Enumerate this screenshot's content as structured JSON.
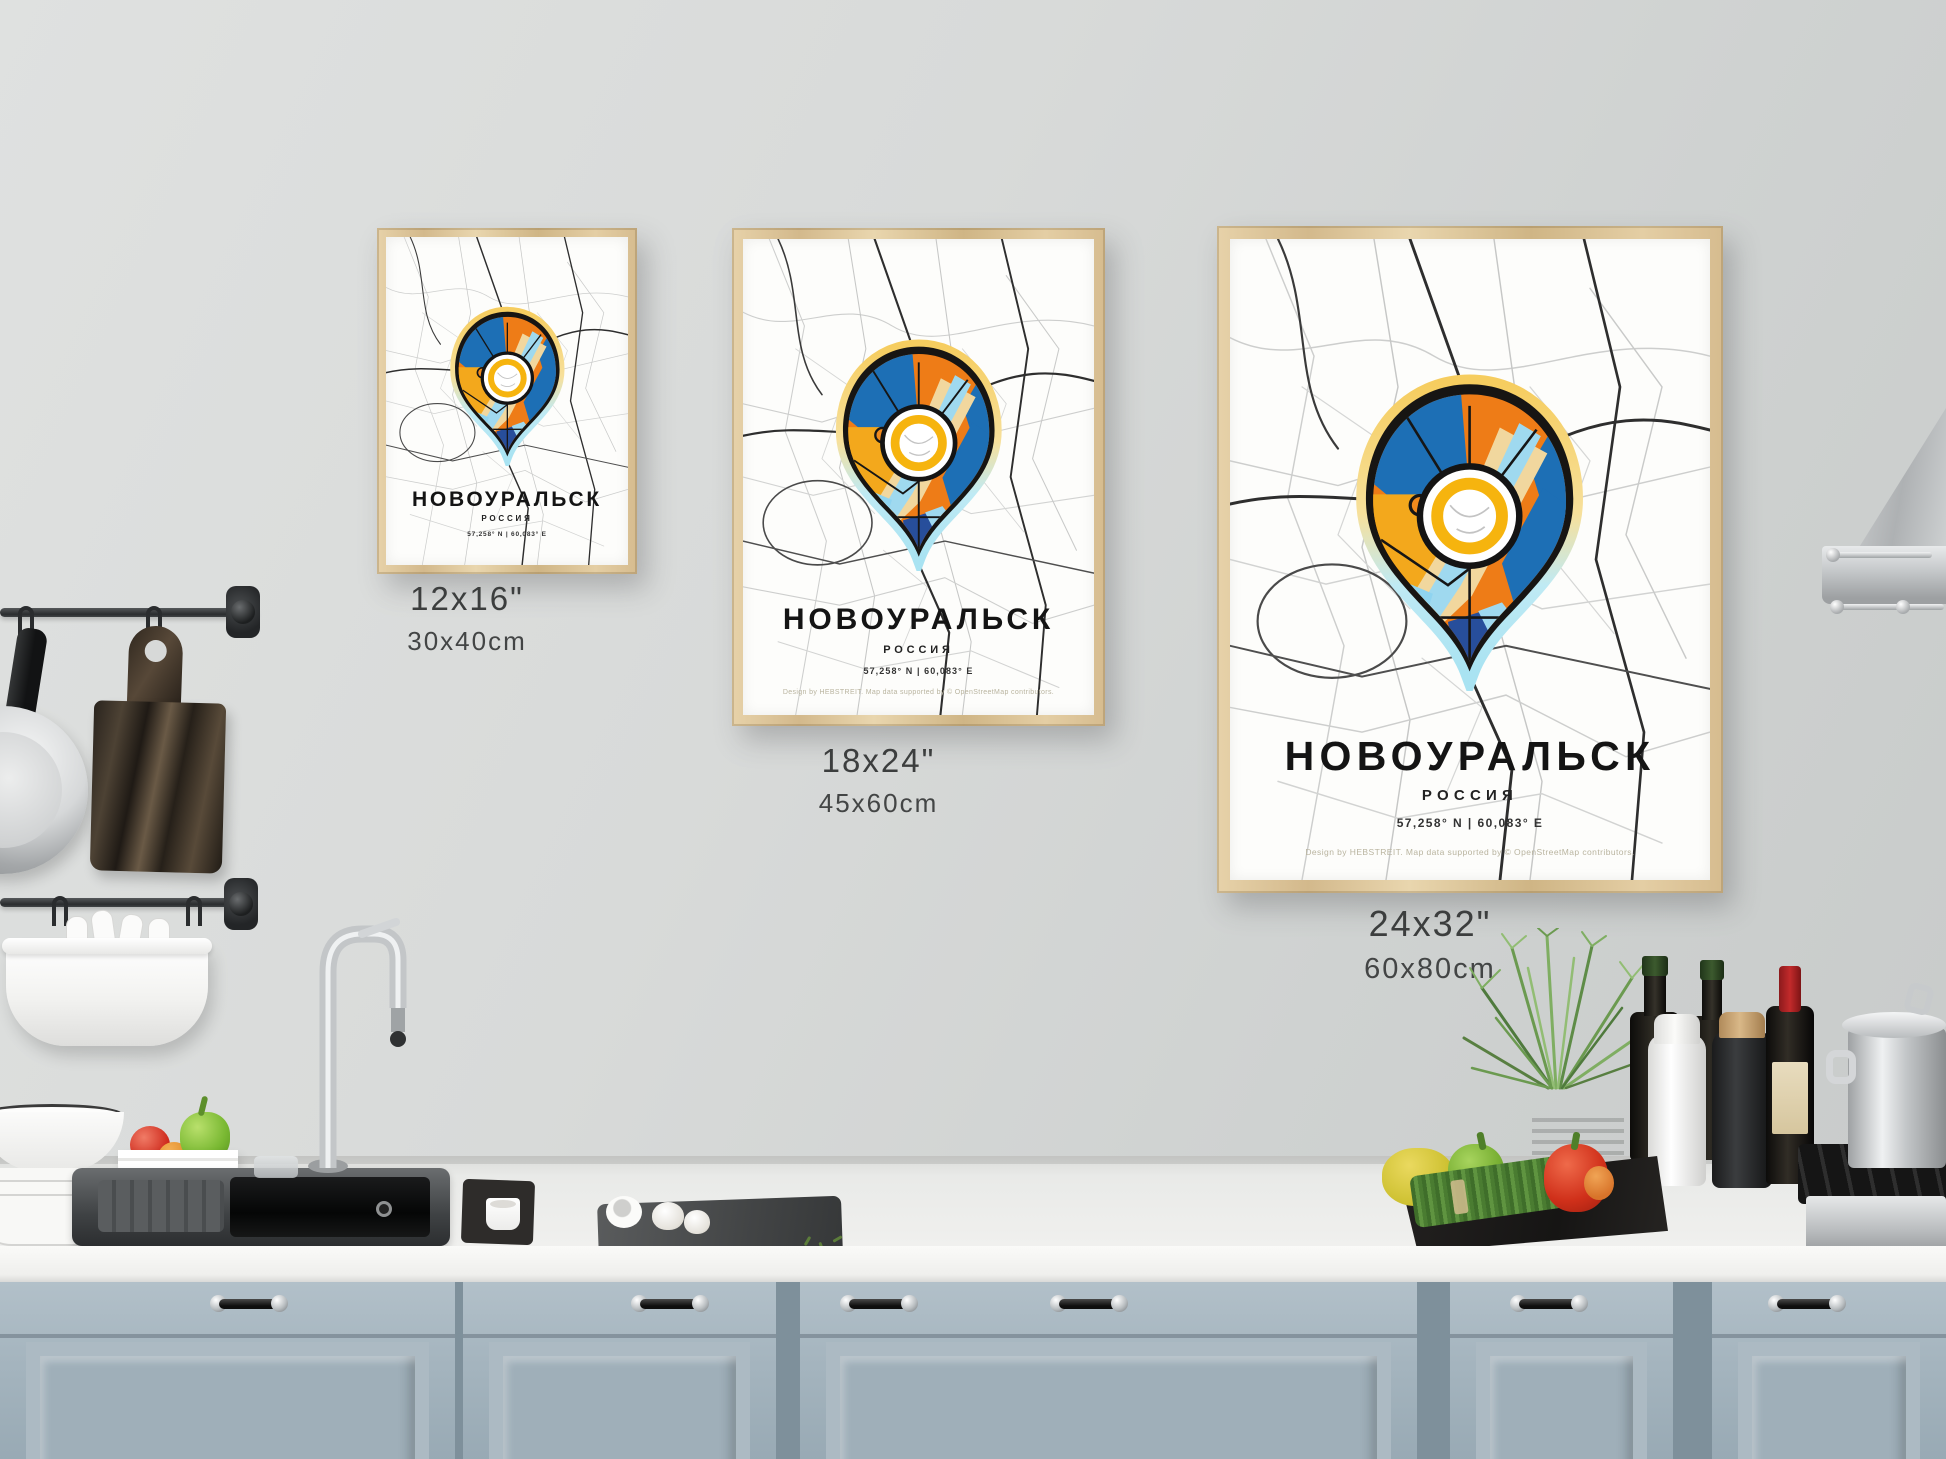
{
  "posters": [
    {
      "id": "small",
      "title": "НОВОУРАЛЬСК",
      "subtitle": "РОССИЯ",
      "coordinates": "57,258° N | 60,083° E",
      "size_in": "12x16\"",
      "size_cm": "30x40cm"
    },
    {
      "id": "medium",
      "title": "НОВОУРАЛЬСК",
      "subtitle": "РОССИЯ",
      "coordinates": "57,258° N | 60,083° E",
      "size_in": "18x24\"",
      "size_cm": "45x60cm",
      "credit": "Design by HEBSTREIT. Map data supported by © OpenStreetMap contributors."
    },
    {
      "id": "large",
      "title": "НОВОУРАЛЬСК",
      "subtitle": "РОССИЯ",
      "coordinates": "57,258° N | 60,083° E",
      "size_in": "24x32\"",
      "size_cm": "60x80cm",
      "credit": "Design by HEBSTREIT. Map data supported by © OpenStreetMap contributors."
    }
  ],
  "icons": {
    "map_pin": "map-pin-icon"
  },
  "colors": {
    "wall_gray": "#d6d8d7",
    "frame_wood": "#d9c193",
    "cabinet_blue_gray": "#a4b4be",
    "map_orange": "#ee7c17",
    "map_blue": "#1d6fb5",
    "map_amber": "#f3a81c",
    "map_light_blue": "#9fd9ef",
    "map_cream": "#f1d79e",
    "pin_ring_yellow": "#f6b40e",
    "pin_glow_yellow": "#f6cd5f",
    "pin_glow_blue": "#a9e3f2"
  }
}
